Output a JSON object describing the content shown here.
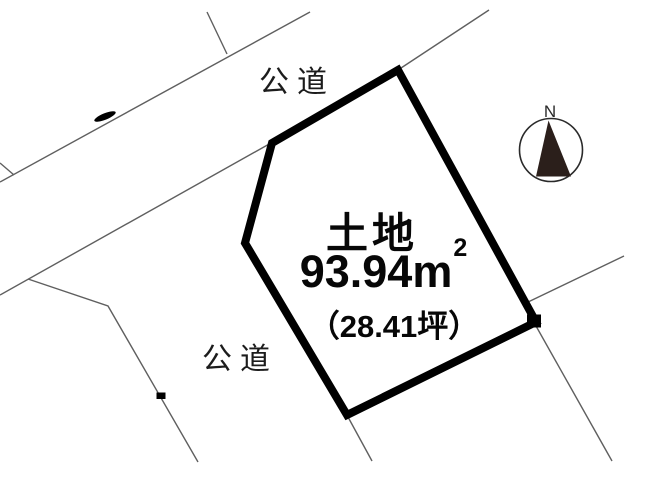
{
  "labels": {
    "road_top": "公道",
    "road_left": "公道",
    "title": "土地",
    "area_value": "93.94",
    "area_unit": "m",
    "area_sup": "2",
    "tsubo": "（28.41坪）"
  },
  "compass": {
    "label": "N"
  },
  "drawing": {
    "thin_color": "#5f5f5f",
    "thick_color": "#000000",
    "mark_color": "#000000",
    "compass_ring_color": "#2a2a2a",
    "needle_color": "#2b1f1b",
    "plot_polygon": [
      [
        398,
        70
      ],
      [
        272,
        143
      ],
      [
        245,
        243
      ],
      [
        347,
        415
      ],
      [
        536,
        322
      ]
    ],
    "thin_lines": [
      [
        [
          0,
          182
        ],
        [
          310,
          12
        ]
      ],
      [
        [
          0,
          163
        ],
        [
          14,
          175
        ]
      ],
      [
        [
          207,
          12
        ],
        [
          227,
          54
        ]
      ],
      [
        [
          0,
          295
        ],
        [
          271,
          143
        ]
      ],
      [
        [
          28,
          279
        ],
        [
          108,
          306
        ],
        [
          198,
          462
        ]
      ],
      [
        [
          398,
          70
        ],
        [
          489,
          10
        ]
      ],
      [
        [
          624,
          256
        ],
        [
          526,
          303
        ]
      ],
      [
        [
          536,
          326
        ],
        [
          612,
          461
        ]
      ],
      [
        [
          348,
          417
        ],
        [
          372,
          461
        ]
      ]
    ],
    "marks": [
      {
        "type": "ellipse",
        "cx": 105,
        "cy": 116.5,
        "rx": 11.5,
        "ry": 3.2,
        "rot": -22
      },
      {
        "type": "rect",
        "x": 156.5,
        "y": 392.5,
        "w": 9,
        "h": 6.5
      },
      {
        "type": "rect",
        "x": 527,
        "y": 314.5,
        "w": 14,
        "h": 13
      }
    ]
  }
}
